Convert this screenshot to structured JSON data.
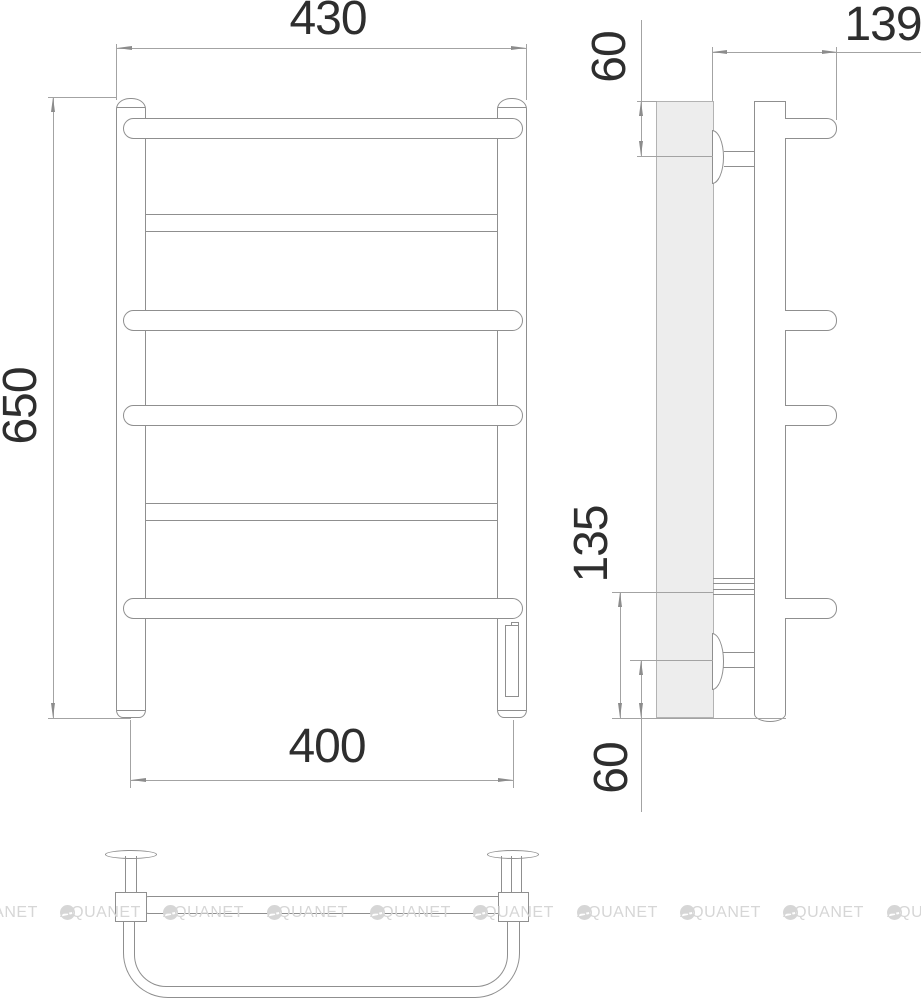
{
  "drawing": {
    "title": "Heated towel rail dimension drawing",
    "front": {
      "width_top": "430",
      "height": "650",
      "width_bottom": "400"
    },
    "side": {
      "depth": "139",
      "top_bracket_offset": "60",
      "lower_span": "135",
      "bottom_bracket_offset": "60"
    },
    "watermark": {
      "text": "AQUANET",
      "logo": "aquanet-circle-logo"
    },
    "colors": {
      "object_line": "#8f8f8f",
      "dimension_line": "#a3a3a3",
      "text": "#2e2e2e",
      "wall_fill": "#ededed",
      "watermark": "#d6d6d6"
    }
  }
}
